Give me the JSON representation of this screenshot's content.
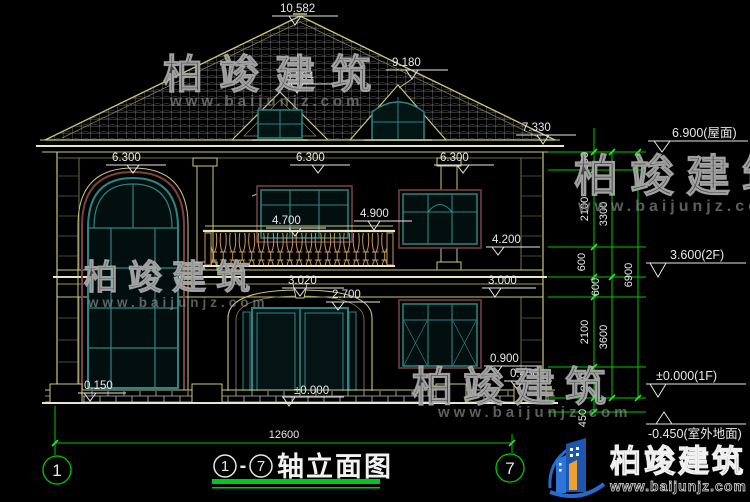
{
  "levels": {
    "peak": "10.582",
    "dormer_left": "8.664",
    "dormer_right": "9.180",
    "eave": "7.330",
    "roof_right": "6.900(屋面)",
    "floor2_right": "3.600(2F)",
    "floor1_right": "±0.000(1F)",
    "ground_right": "-0.450(室外地面)",
    "win63_left": "6.300",
    "win63_mid": "6.300",
    "win63_right": "6.300",
    "rail_top": "4.900",
    "handrail": "4.700",
    "sill2_right": "4.200",
    "arch_top": "3.020",
    "band_bottom": "3.000",
    "arch_spring": "2.700",
    "sill1_right": "0.900",
    "plinth_right": "0.450",
    "plinth_left": "0.150",
    "entrance": "±0.000"
  },
  "dims": {
    "right_inner": [
      "600",
      "2100",
      "600",
      "600",
      "2100",
      "900",
      "450"
    ],
    "right_mid": [
      "3300",
      "3600"
    ],
    "right_total": "6900",
    "bottom_total": "12600"
  },
  "axes": {
    "left": "1",
    "right": "7"
  },
  "title": {
    "start": "1",
    "sep": "-",
    "end": "7",
    "label": "轴立面图"
  },
  "watermark": {
    "brand": "柏竣建筑",
    "url": "www.baijunjz.com"
  },
  "logo": {
    "brand": "柏竣建筑",
    "url": "www.baijunjz.com"
  },
  "colors": {
    "background": "#000000",
    "cad_yellow": "#c8c87c",
    "cad_white": "#e8e8e8",
    "window_teal": "#2e8484",
    "trim_maroon": "#7a4242",
    "dim_green": "#00c800",
    "tick_green": "#34e034",
    "title_green": "#00c818",
    "logo_blue": "#1d58b0",
    "logo_orange": "#f0a030",
    "watermark_gray": "#8f8f8f"
  }
}
